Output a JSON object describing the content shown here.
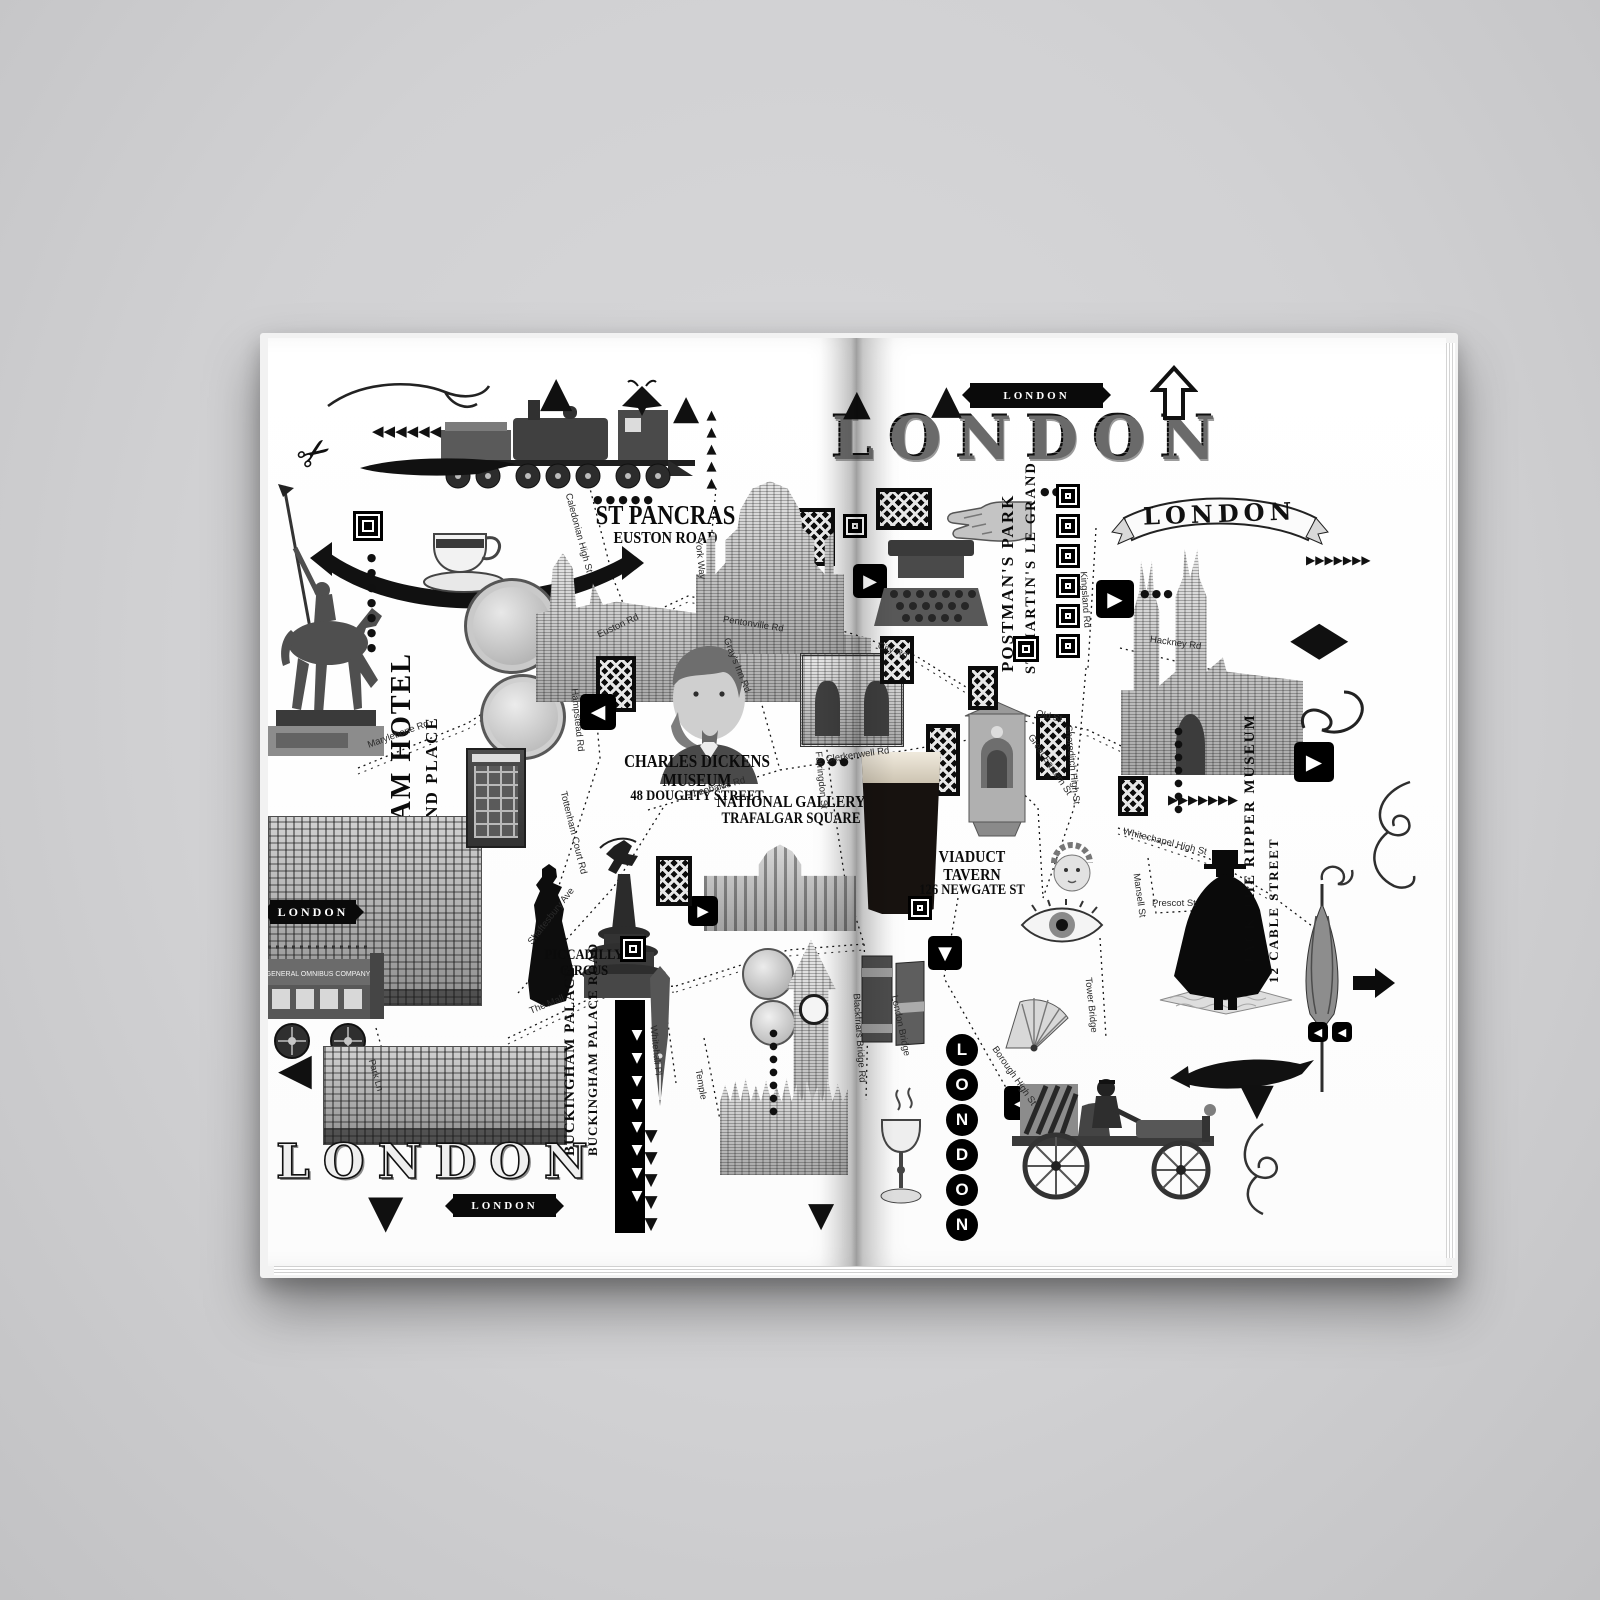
{
  "scene": {
    "background_color": "#d1d1d3",
    "page_color": "#ffffff",
    "ink_color": "#0d0d0d"
  },
  "left_page": {
    "title_bottom": "LONDON",
    "ribbon_bottom": "LONDON",
    "banner_bus": "LONDON",
    "bus_side_text": "GENERAL OMNIBUS COMPANY",
    "landmarks": {
      "st_pancras": {
        "name": "ST PANCRAS",
        "address": "EUSTON ROAD"
      },
      "langham_hotel": {
        "name": "LANGHAM HOTEL",
        "address": "1C PORTLAND PLACE"
      },
      "charles_dickens": {
        "name": "CHARLES DICKENS MUSEUM",
        "address": "48 DOUGHTY STREET"
      },
      "national_gallery": {
        "name": "NATIONAL GALLERY",
        "address": "TRAFALGAR SQUARE"
      },
      "piccadilly_circus": {
        "name": "PICCADILLY CIRCUS"
      },
      "buckingham_palace": {
        "name": "BUCKINGHAM PALACE",
        "address": "BUCKINGHAM PALACE ROAD"
      }
    },
    "streets": {
      "caledonian_high_st": "Caledonian High St",
      "york_way": "York Way",
      "hampstead_rd": "Hampstead Rd",
      "euston_rd": "Euston Rd",
      "pentonville_rd": "Pentonville Rd",
      "marylebone_rd": "Marylebone Rd",
      "tottenham_court_rd": "Tottenham Court Rd",
      "grays_inn_rd": "Gray's Inn Rd",
      "theobalds_rd": "Theobalds Rd",
      "farringdon_st": "Farringdon St",
      "park_ln": "Park Ln",
      "shaftesbury_ave": "Shaftesbury Ave",
      "the_mall": "The Mall",
      "whitehall_pl": "Whitehall Pl",
      "temple": "Temple"
    }
  },
  "right_page": {
    "title_main": "LONDON",
    "banner_top": "LONDON",
    "ribbon_right": "LONDON",
    "vertical_badge": "LONDON",
    "landmarks": {
      "postmans_park": {
        "name": "POSTMAN'S PARK",
        "address": "ST MARTIN'S LE GRAND"
      },
      "viaduct_tavern": {
        "name": "VIADUCT TAVERN",
        "address": "126 NEWGATE ST"
      },
      "jack_the_ripper": {
        "name": "JACK THE RIPPER MUSEUM",
        "address": "12 CABLE STREET"
      }
    },
    "streets": {
      "city_rd": "City Rd",
      "old_st": "Old St",
      "clerkenwell_rd": "Clerkenwell Rd",
      "great_eastern_st": "Great Eastern St",
      "shoreditch_high_st": "Shoreditch High St",
      "kingsland_rd": "Kingsland Rd",
      "hackney_rd": "Hackney Rd",
      "whitechapel_high_st": "Whitechapel High St",
      "mansell_st": "Mansell St",
      "prescot_st": "Prescot St",
      "blackfriars_bridge_rd": "Blackfriars Bridge Rd",
      "london_bridge": "London Bridge",
      "borough_high_st": "Borough High St",
      "tower_bridge": "Tower Bridge"
    }
  },
  "glyphs": {
    "up_arrow": "▲",
    "down_arrow": "▼",
    "left_arrow": "◀",
    "right_arrow": "▶",
    "diamond": "◆",
    "scissors": "✂",
    "chevrons_left": "◀◀◀◀◀◀",
    "chevrons_right": "▶▶▶▶▶▶▶",
    "chevrons_down_long": "▼▼▼▼▼▼▼▼",
    "chevrons_down": "▼▼▼▼▼",
    "dots3": "●●●",
    "dots5": "●●●●●",
    "dots_col": "●●●●●●●",
    "triangles_col": "▲▲▲▲▲",
    "double_left": "◀◀"
  }
}
